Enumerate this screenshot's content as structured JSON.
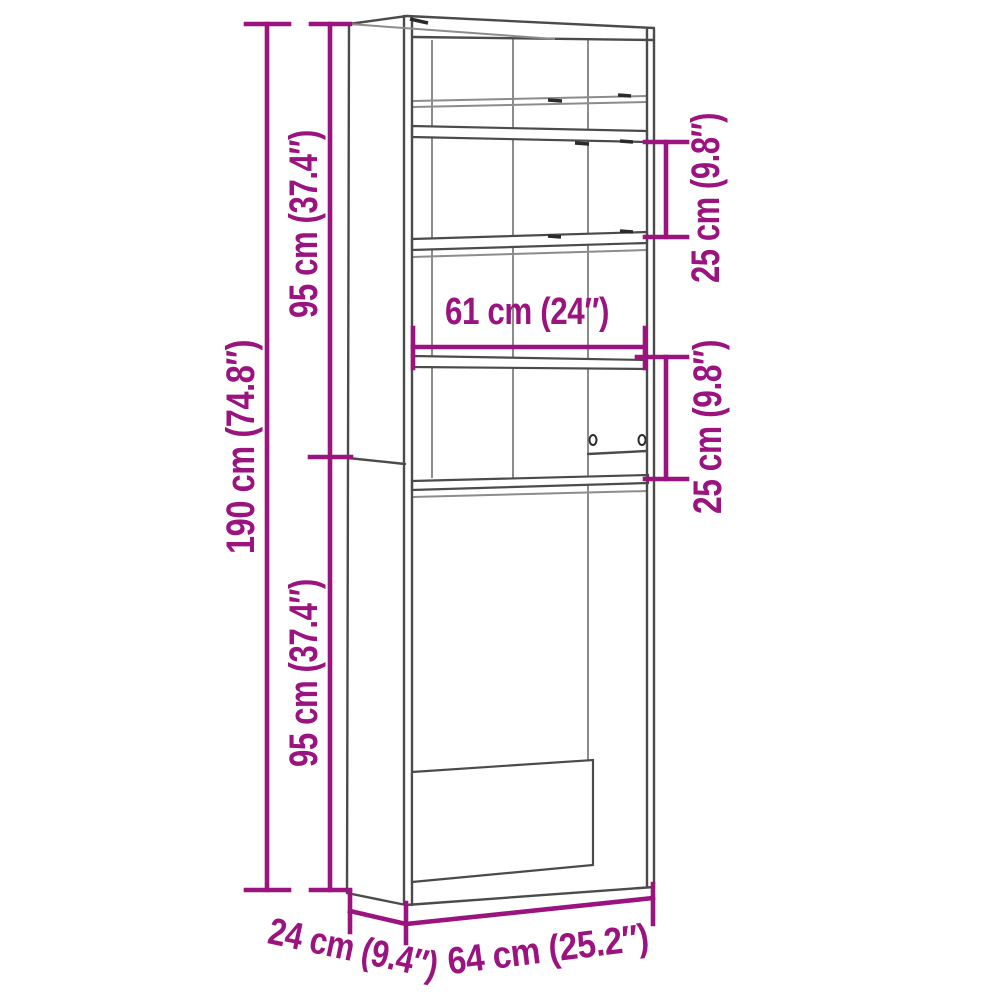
{
  "diagram": {
    "type": "furniture dimension drawing",
    "view": "three-quarter line drawing of a tall open shelving cabinet with washing machine opening"
  },
  "dimensions": {
    "overall_height": {
      "cm": 190,
      "in": 74.8,
      "label": "190 cm (74.8″)"
    },
    "upper_section_height": {
      "cm": 95,
      "in": 37.4,
      "label": "95 cm (37.4″)"
    },
    "lower_section_height": {
      "cm": 95,
      "in": 37.4,
      "label": "95 cm (37.4″)"
    },
    "upper_shelf_spacing": {
      "cm": 25,
      "in": 9.8,
      "label": "25 cm (9.8″)"
    },
    "lower_shelf_spacing": {
      "cm": 25,
      "in": 9.8,
      "label": "25 cm (9.8″)"
    },
    "inner_width": {
      "cm": 61,
      "in": 24,
      "label": "61 cm (24″)"
    },
    "depth": {
      "cm": 24,
      "in": 9.4,
      "label": "24 cm (9.4″)"
    },
    "overall_width": {
      "cm": 64,
      "in": 25.2,
      "label": "64 cm (25.2″)"
    }
  },
  "colors": {
    "dimension": "#9A137F",
    "outline": "#4b4b4b",
    "outline_light": "#8c8c8c",
    "background": "#ffffff"
  }
}
